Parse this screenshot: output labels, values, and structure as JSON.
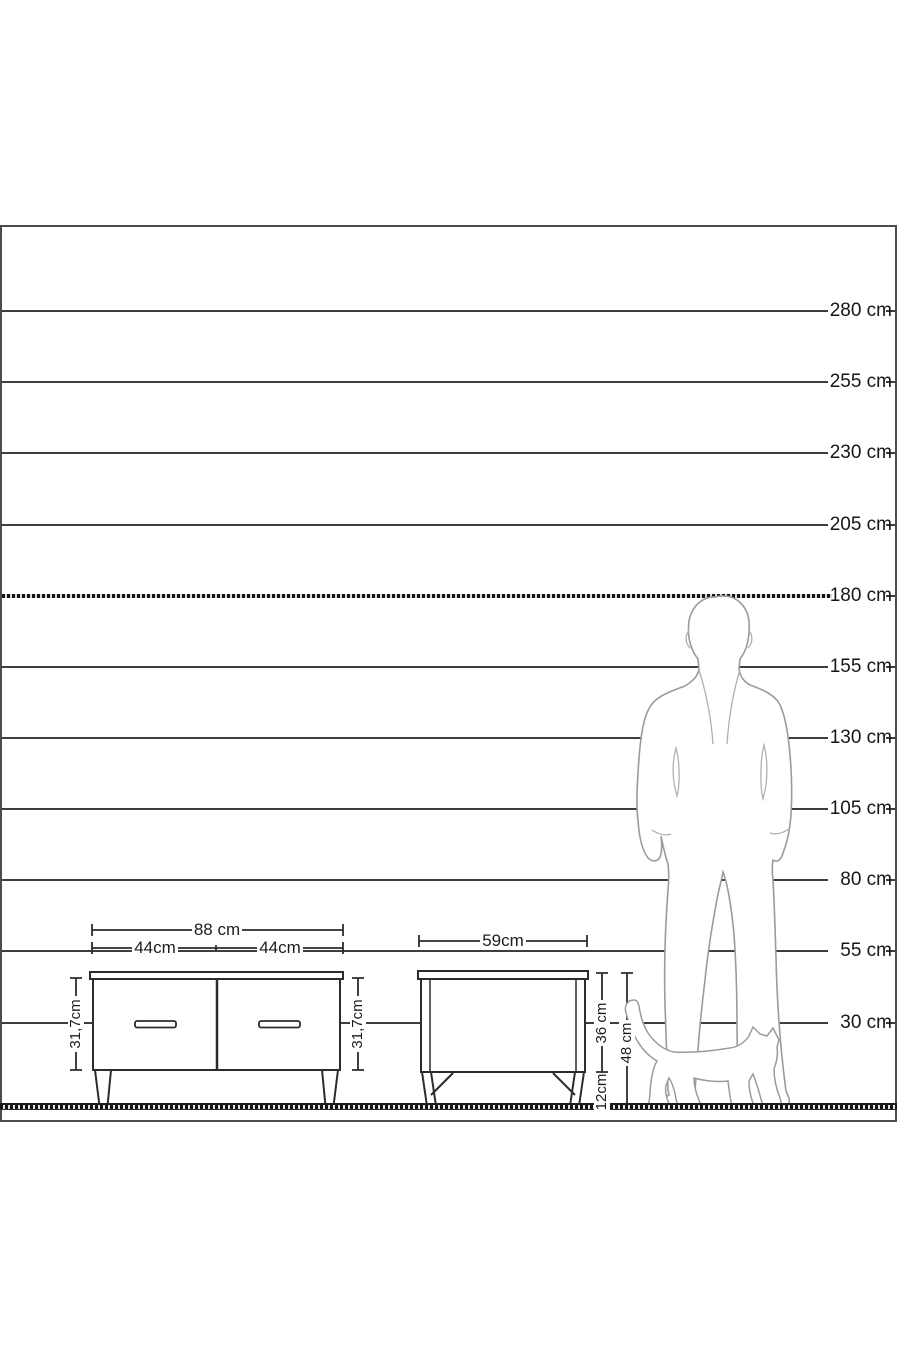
{
  "ruler": {
    "unit": "cm",
    "bold_line_cm": 180,
    "gridlines": [
      {
        "cm": 280,
        "label": "280 cm"
      },
      {
        "cm": 255,
        "label": "255 cm"
      },
      {
        "cm": 230,
        "label": "230 cm"
      },
      {
        "cm": 205,
        "label": "205 cm"
      },
      {
        "cm": 180,
        "label": "180 cm"
      },
      {
        "cm": 155,
        "label": "155 cm"
      },
      {
        "cm": 130,
        "label": "130 cm"
      },
      {
        "cm": 105,
        "label": "105 cm"
      },
      {
        "cm": 80,
        "label": "80 cm"
      },
      {
        "cm": 55,
        "label": "55 cm"
      },
      {
        "cm": 30,
        "label": "30 cm"
      }
    ]
  },
  "tv_stand": {
    "width_label": "88 cm",
    "left_door_width_label": "44cm",
    "right_door_width_label": "44cm",
    "left_height_label": "31,7cm",
    "right_height_label": "31,7cm"
  },
  "nightstand": {
    "width_label": "59cm",
    "body_height_label": "36 cm",
    "leg_height_label": "12cm",
    "total_height_label": "48 cm"
  },
  "colors": {
    "line": "#3e3e3e",
    "furniture_stroke": "#2c2c2c",
    "silhouette_stroke": "#9b9b9b",
    "background": "#ffffff"
  }
}
